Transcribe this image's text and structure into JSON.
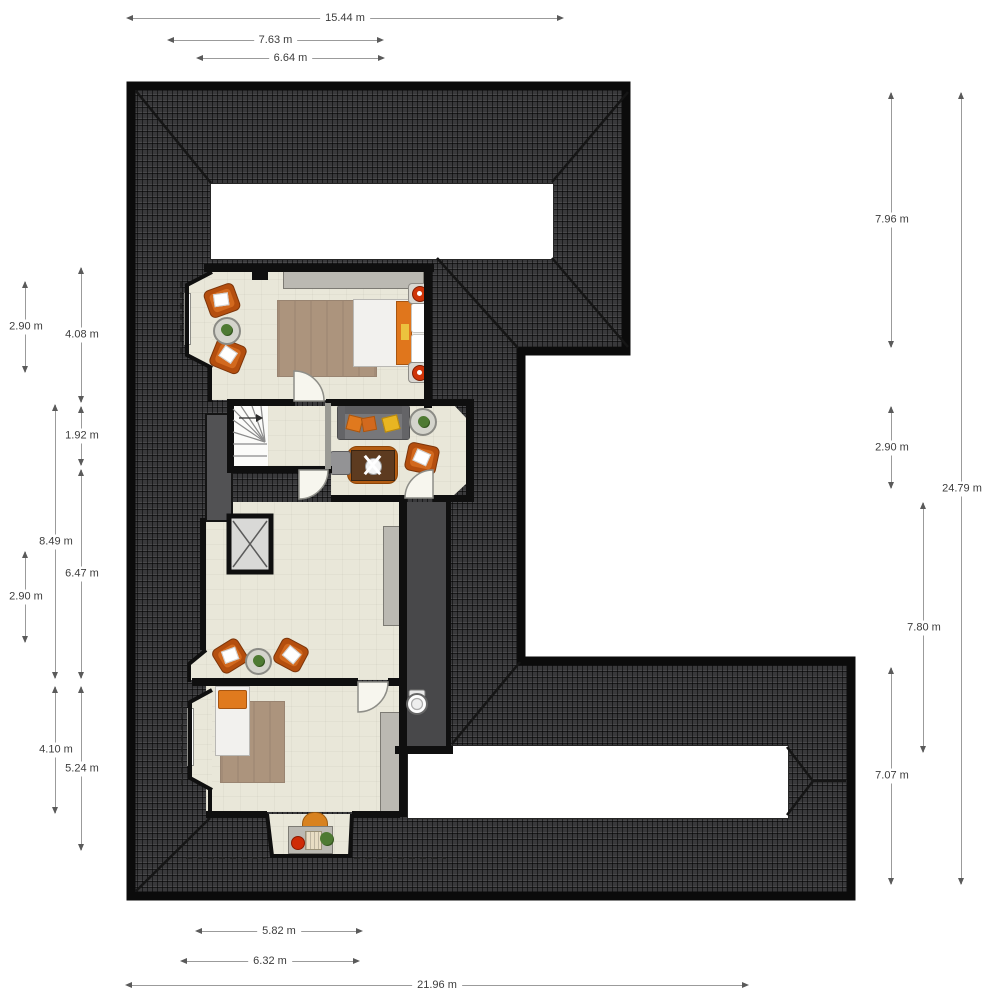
{
  "plan": {
    "type": "attic-floor-plan",
    "unit": "m",
    "dimensions": {
      "top": [
        "15.44 m",
        "7.63 m",
        "6.64 m"
      ],
      "bottom": [
        "5.82 m",
        "6.32 m",
        "21.96 m"
      ],
      "left": [
        "2.90 m",
        "4.08 m",
        "1.92 m",
        "8.49 m",
        "6.47 m",
        "2.90 m",
        "4.10 m",
        "5.24 m"
      ],
      "right": [
        "7.96 m",
        "2.90 m",
        "24.79 m",
        "7.80 m",
        "7.07 m"
      ]
    },
    "colors": {
      "roof": "#39393b",
      "wall": "#0f0f0f",
      "floor": "#e9e7d9",
      "wc_floor": "#48484a",
      "accent_orange": "#c8651b",
      "dimension_line": "#9b9b9b",
      "dimension_text": "#3c3c3c"
    },
    "rooms": [
      "master-bedroom",
      "stairs",
      "landing",
      "tv-office-room",
      "hallway",
      "wc",
      "child-bedroom",
      "dormer-nook",
      "storage",
      "elevator-shaft"
    ],
    "furniture_icons": [
      "double-bed",
      "nightstand",
      "dresser",
      "rug",
      "armchair",
      "plant-table",
      "sofa",
      "coffee-table",
      "desk",
      "office-chair",
      "side-chair",
      "wardrobe",
      "single-bed",
      "toilet",
      "winder-stairs",
      "half-round-chair",
      "side-table"
    ]
  }
}
